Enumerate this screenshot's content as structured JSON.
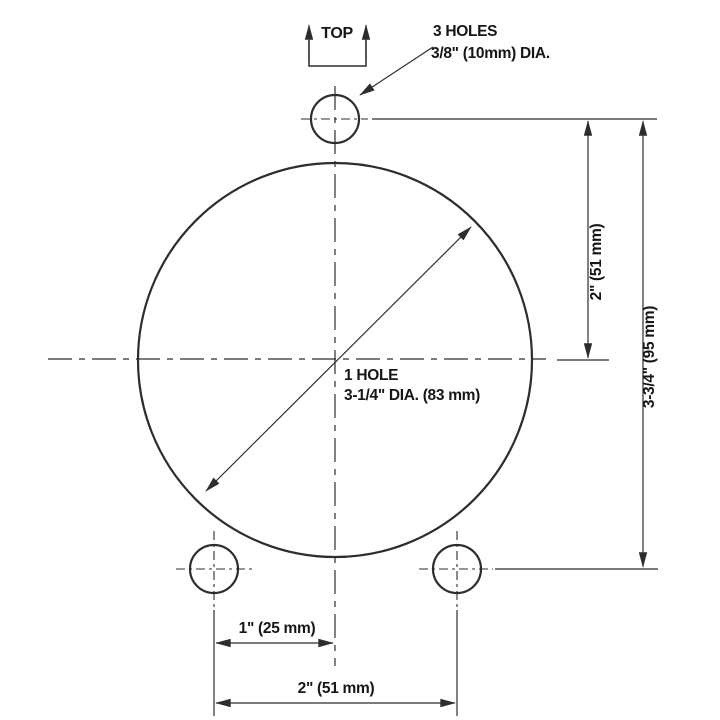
{
  "drawing": {
    "top_marker": "TOP",
    "callout_top_holes": {
      "line1": "3 HOLES",
      "line2": "3/8\" (10mm) DIA."
    },
    "callout_center_hole": {
      "line1": "1 HOLE",
      "line2": "3-1/4\" DIA. (83 mm)"
    },
    "dimensions": {
      "top_hole_to_centerline": "2\" (51 mm)",
      "top_hole_to_bottom_holes": "3-3/4\" (95 mm)",
      "bottom_hole_to_centerline": "1\" (25 mm)",
      "bottom_hole_spacing": "2\" (51 mm)"
    },
    "colors": {
      "line": "#2d2d2d",
      "text": "#161616",
      "background": "#ffffff"
    }
  }
}
